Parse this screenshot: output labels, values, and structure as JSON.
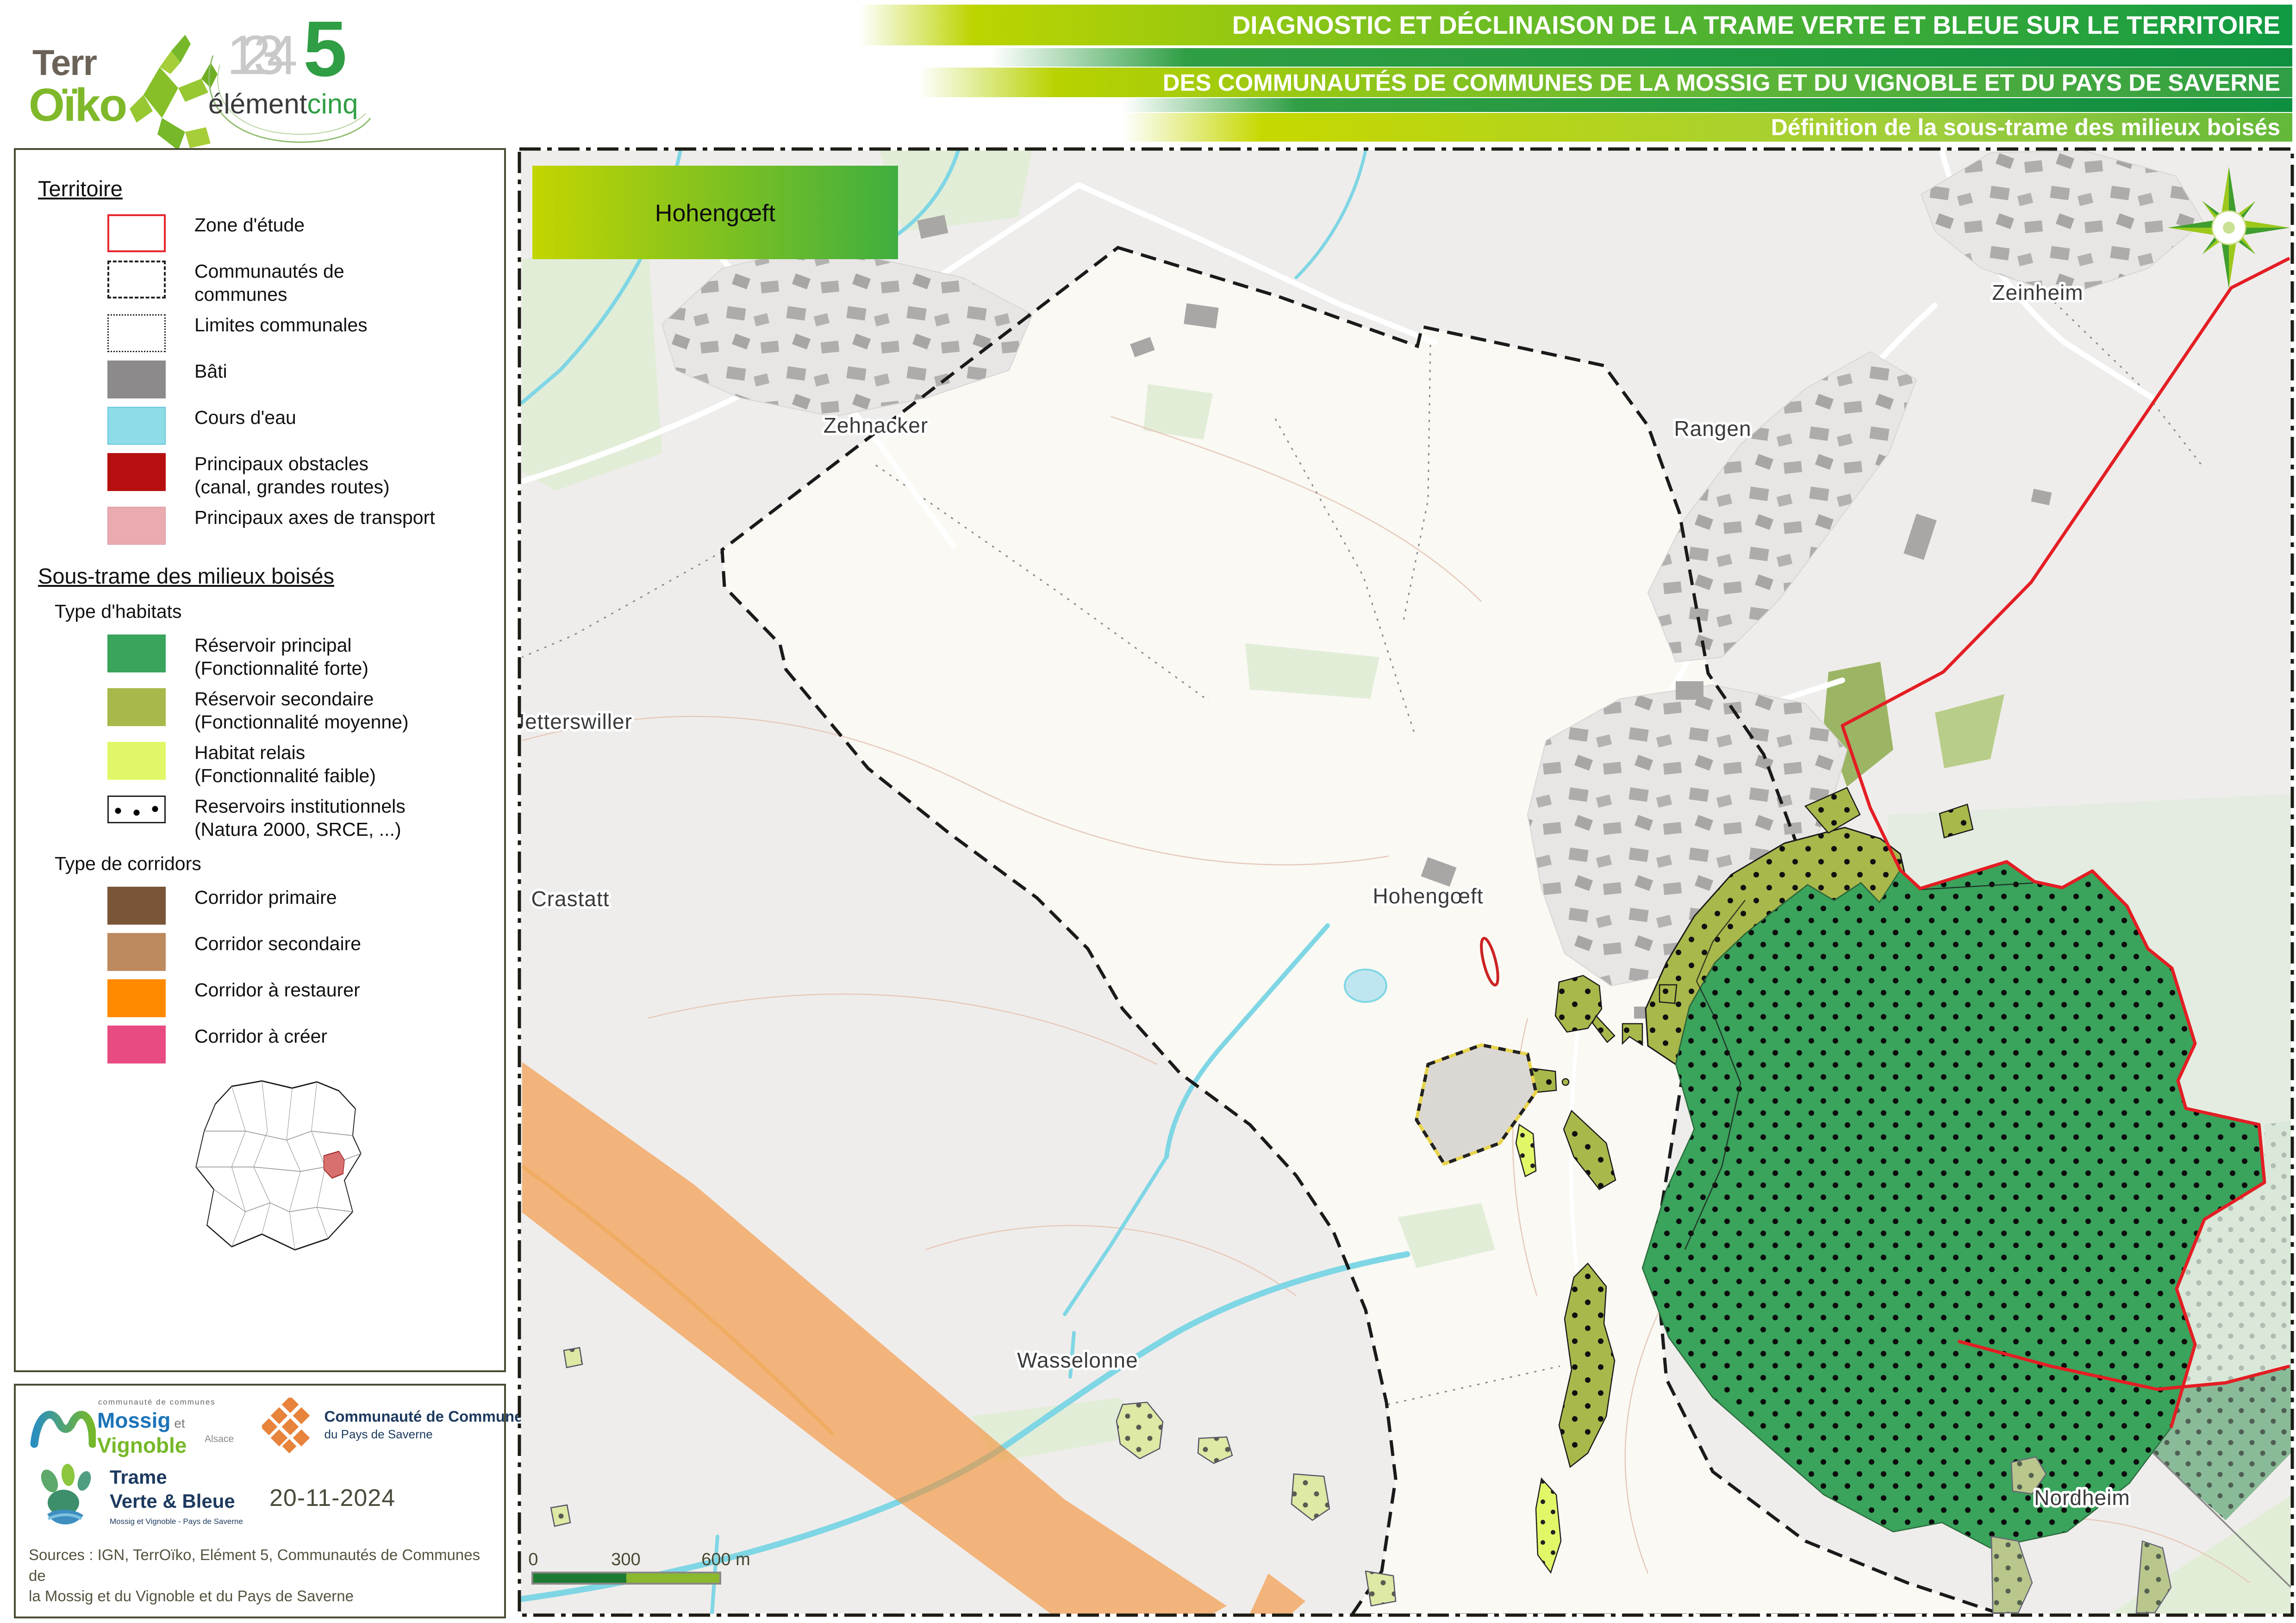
{
  "header": {
    "logo_terroiko": {
      "line1": "Terr",
      "line2": "Oïko"
    },
    "logo_element": {
      "numbers": [
        "1",
        "2",
        "3",
        "4"
      ],
      "five": "5",
      "element": "élément",
      "cinq": "cinq"
    },
    "bars": [
      {
        "label": "DIAGNOSTIC ET DÉCLINAISON DE LA TRAME VERTE ET BLEUE SUR LE TERRITOIRE"
      },
      {
        "label": "DES COMMUNAUTÉS DE COMMUNES DE LA MOSSIG ET DU VIGNOBLE ET DU PAYS DE SAVERNE"
      },
      {
        "label": "Définition de la sous-trame des milieux boisés"
      }
    ]
  },
  "legend": {
    "territoire_title": "Territoire",
    "territoire_items": [
      {
        "label": "Zone d'étude",
        "label2": ""
      },
      {
        "label": "Communautés de",
        "label2": "communes"
      },
      {
        "label": "Limites communales",
        "label2": ""
      },
      {
        "label": "Bâti",
        "label2": ""
      },
      {
        "label": "Cours d'eau",
        "label2": ""
      },
      {
        "label": "Principaux obstacles",
        "label2": "(canal, grandes routes)"
      },
      {
        "label": "Principaux axes de transport",
        "label2": ""
      }
    ],
    "sous_trame_title": "Sous-trame des milieux boisés",
    "habitats_title": "Type d'habitats",
    "habitats": [
      {
        "label": "Réservoir principal",
        "label2": "(Fonctionnalité forte)",
        "color": "#3aa35c"
      },
      {
        "label": "Réservoir secondaire",
        "label2": "(Fonctionnalité moyenne)",
        "color": "#a9b84b"
      },
      {
        "label": "Habitat relais",
        "label2": "(Fonctionnalité faible)",
        "color": "#e2f768"
      },
      {
        "label": "Reservoirs institutionnels",
        "label2": "(Natura 2000, SRCE, ...)",
        "color": "#ffffff"
      }
    ],
    "corridors_title": "Type de corridors",
    "corridors": [
      {
        "label": "Corridor primaire",
        "color": "#7a5638"
      },
      {
        "label": "Corridor secondaire",
        "color": "#bd8a60"
      },
      {
        "label": "Corridor à restaurer",
        "color": "#ff8a00"
      },
      {
        "label": "Corridor à créer",
        "color": "#e84b82"
      }
    ]
  },
  "info": {
    "mossig": {
      "top": "communauté de communes",
      "name1": "Mossig",
      "et": " et ",
      "name2": "Vignoble",
      "region": "Alsace"
    },
    "saverne": {
      "line1": "Communauté de Communes",
      "line2": "du Pays de Saverne"
    },
    "tvb": {
      "line1": "Trame",
      "line2": "Verte & Bleue",
      "sub": "Mossig et Vignoble - Pays de Saverne"
    },
    "date": "20-11-2024",
    "sources_line1": "Sources : IGN, TerrOïko, Elément 5, Communautés de Communes de",
    "sources_line2": "la Mossig et du Vignoble et du Pays de Saverne"
  },
  "map": {
    "title_box": "Hohengœft",
    "labels": [
      "Zehnacker",
      "Zeinheim",
      "Rangen",
      "Jetterswiller",
      "Hohengœft",
      "Crastatt",
      "Wasselonne",
      "Nordheim"
    ],
    "scale": {
      "t0": "0",
      "t1": "300",
      "t2": "600 m"
    }
  },
  "colors": {
    "accent_green": "#2f9e44",
    "accent_yellowgreen": "#bcd400",
    "reservoir_principal": "#3aa35c",
    "reservoir_secondaire": "#a9b84b",
    "habitat_relais": "#e2f768",
    "corridor_primaire": "#7a5638",
    "corridor_secondaire": "#bd8a60",
    "corridor_restaurer": "#ff8a00",
    "corridor_creer": "#e84b82",
    "obstacle": "#b70f0f",
    "axes_transport": "#e9aab0",
    "cours_eau": "#8edce8",
    "bati": "#8c8a8a",
    "zone_etude": "#e31e24"
  }
}
